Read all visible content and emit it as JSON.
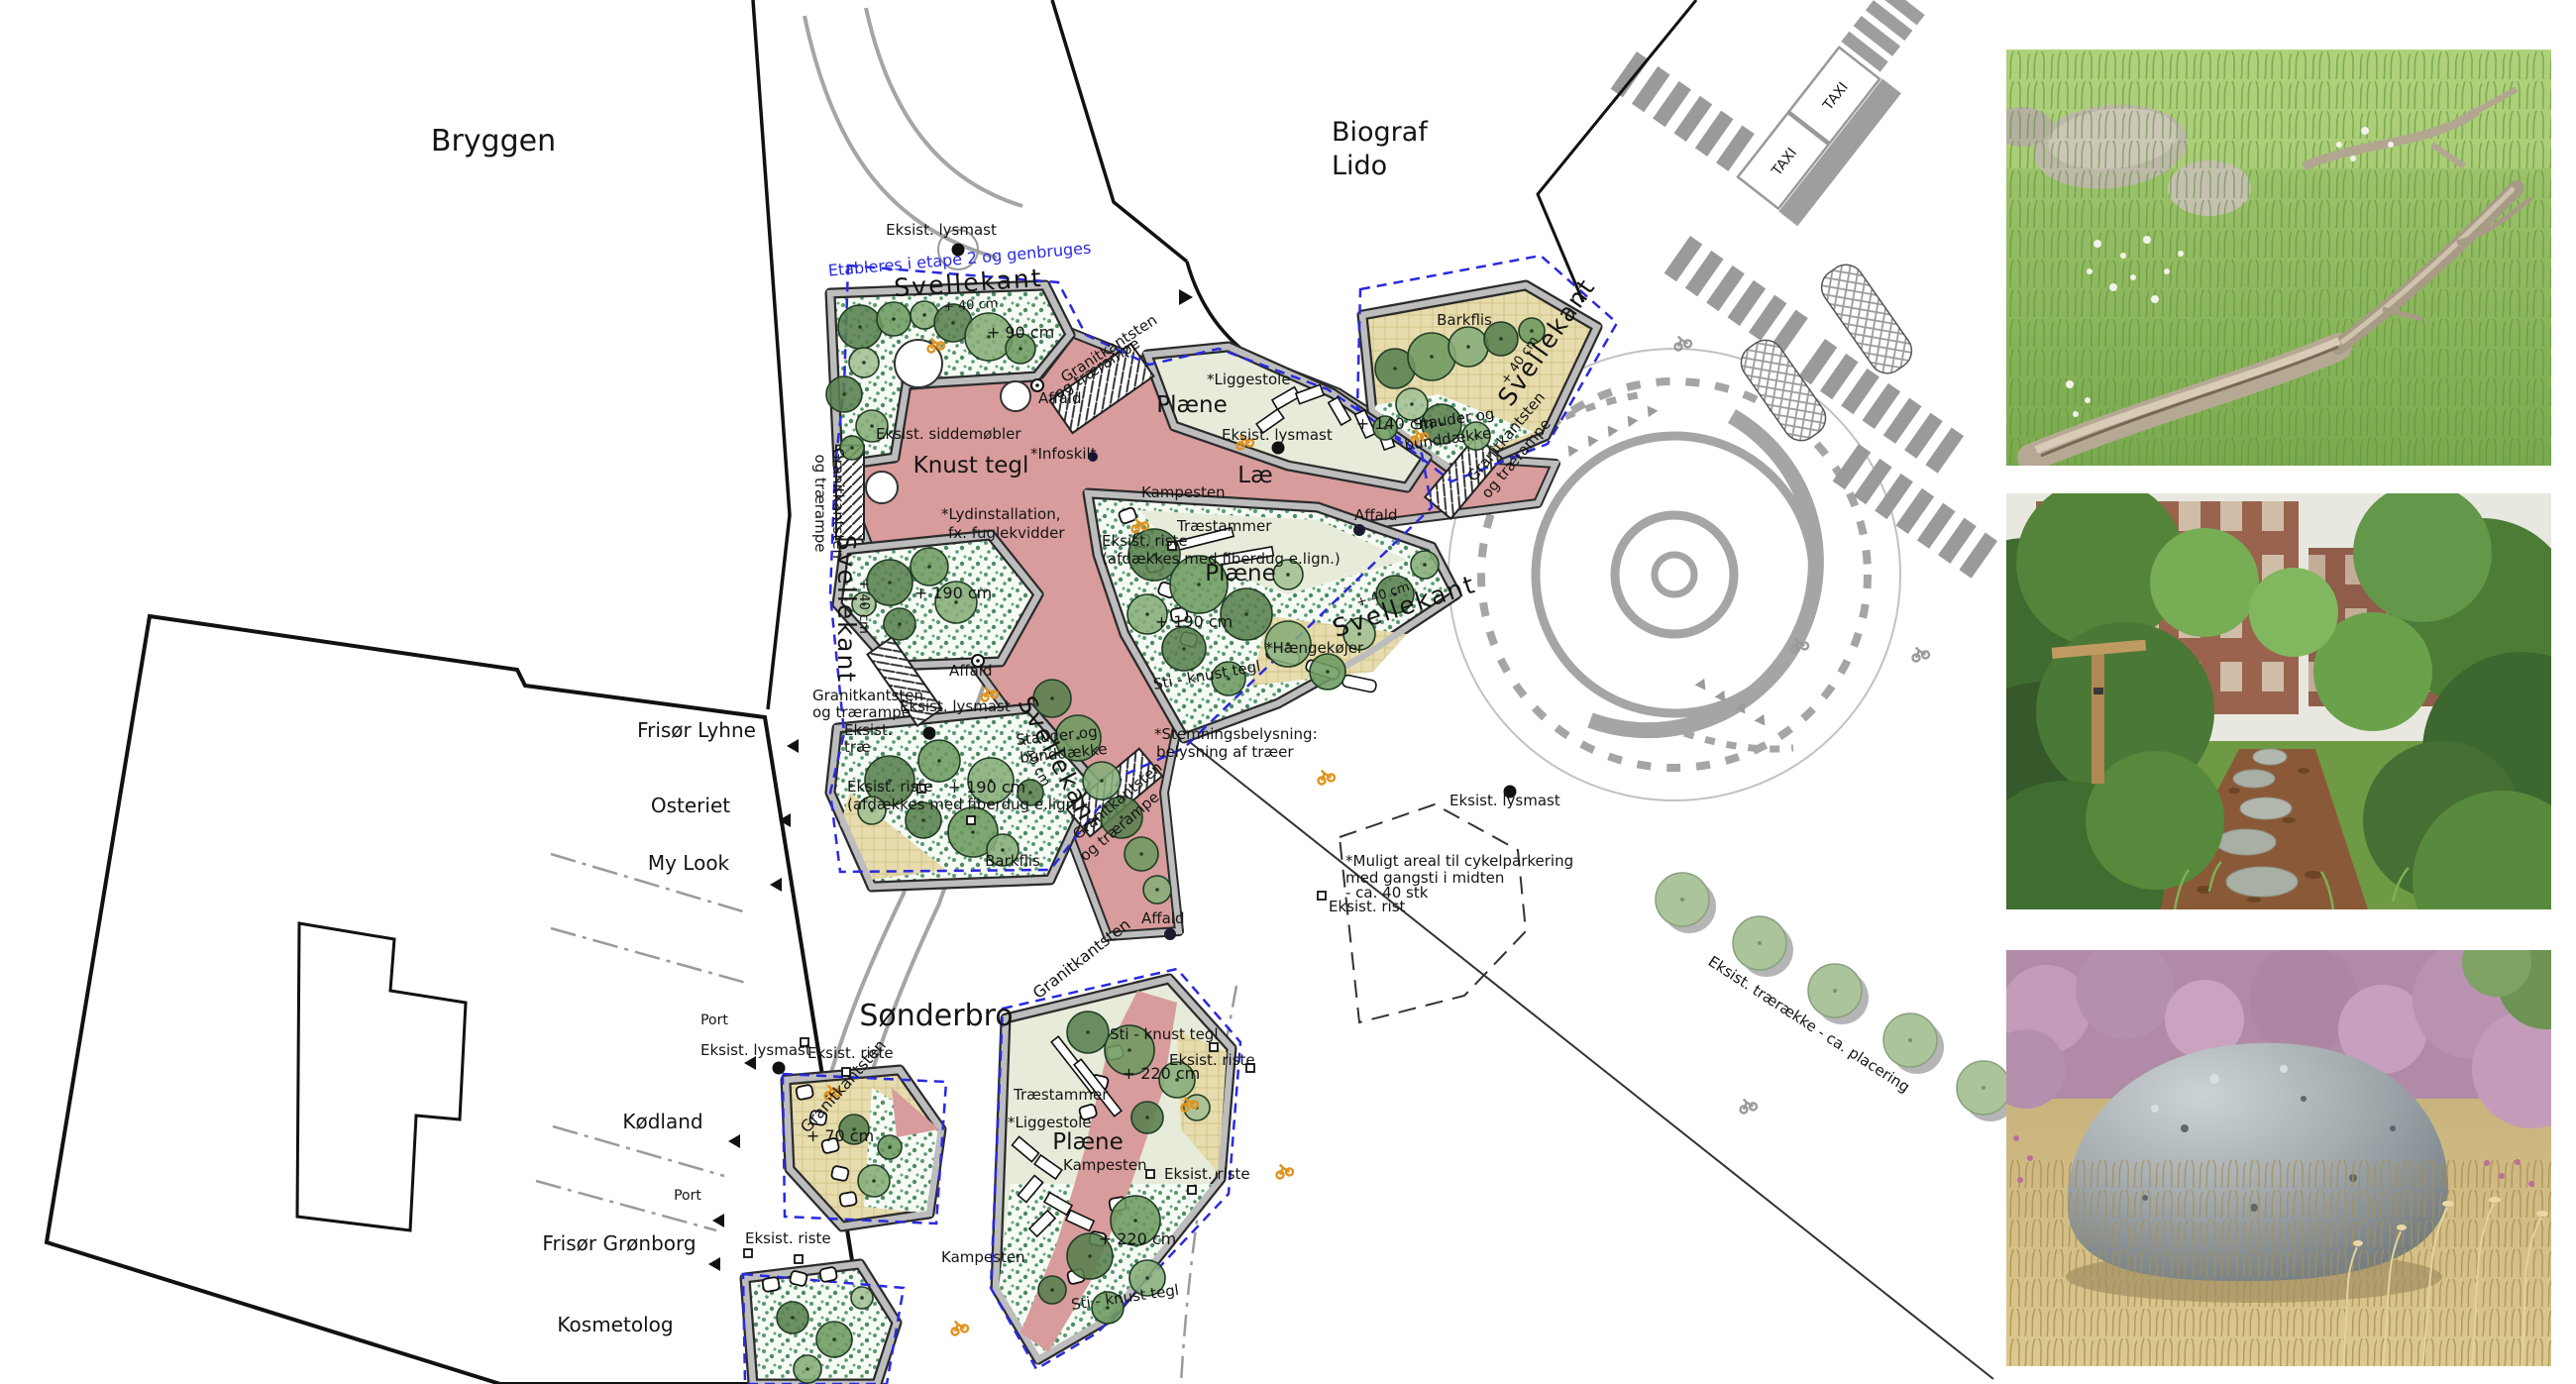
{
  "plan": {
    "streets": {
      "bryggen": "Bryggen",
      "soenderbro": "Sønderbro"
    },
    "buildings": {
      "biograf": [
        "Biograf",
        "Lido"
      ],
      "frisoer_lyhne": "Frisør Lyhne",
      "osteriet": "Osteriet",
      "my_look": "My Look",
      "port": "Port",
      "koedland": "Kødland",
      "frisoer_groenborg": "Frisør Grønborg",
      "kosmetolog": "Kosmetolog"
    },
    "labels": {
      "eksist_lysmast": "Eksist. lysmast",
      "etableres": "Etableres i etape 2 og genbruges",
      "svellekant": "Svellekant",
      "plus40": "+ 40 cm",
      "plus70": "+ 70 cm",
      "plus90": "+ 90 cm",
      "plus140": "+ 140 cm",
      "plus190": "+ 190 cm",
      "plus220": "+ 220 cm",
      "granit_tr": [
        "Granitkantsten",
        "og trærampe"
      ],
      "granitkantsten": "Granitkantsten",
      "stauder": [
        "Stauder og",
        "bunddække"
      ],
      "affald": "Affald",
      "plaene": "Plæne",
      "liggestole": "*Liggestole",
      "lae": "Læ",
      "knust_tegl": "Knust tegl",
      "infoskilt": "*Infoskilt",
      "siddemoebler": "Eksist. siddemøbler",
      "lyd": [
        "*Lydinstallation,",
        "fx. fuglekvidder"
      ],
      "kampesten": "Kampesten",
      "traestammer": "Træstammer",
      "riste_afd": [
        "Eksist. riste",
        "(afdækkes med fiberdug e.lign.)"
      ],
      "haengekoejer": "*Hængekøjer",
      "sti_knust": "Sti - knust tegl",
      "stemning": [
        "*Stemningsbelysning:",
        "belysning af træer"
      ],
      "eksist_trae": [
        "Eksist.",
        "træ"
      ],
      "eksist_riste": "Eksist. riste",
      "eksist_rist": "Eksist. rist",
      "barkflis": "Barkflis",
      "muligt": [
        "*Muligt areal til cykelparkering",
        "med gangsti i midten",
        "- ca. 40 stk"
      ],
      "traeraekke": "Eksist. trærække - ca. placering",
      "taxi": "TAXI"
    },
    "colors": {
      "crushed_brick_pink": "#d89c9c",
      "lawn_green": "#e7ecda",
      "bark_mulch": "#e6dcae",
      "planting_speckle_green": "#57996e",
      "edge_gray": "#bdbdbd",
      "outline_dark": "#2b2b2b",
      "phase_dashed_blue": "#2a2ae0",
      "road_gray": "#a5a5a5",
      "accent_orange": "#e0921e"
    }
  },
  "photos": {
    "top": "meadow-with-fallen-log",
    "middle": "woodland-path-with-stepping-stones",
    "bottom": "boulder-in-dry-grass-with-heather"
  }
}
